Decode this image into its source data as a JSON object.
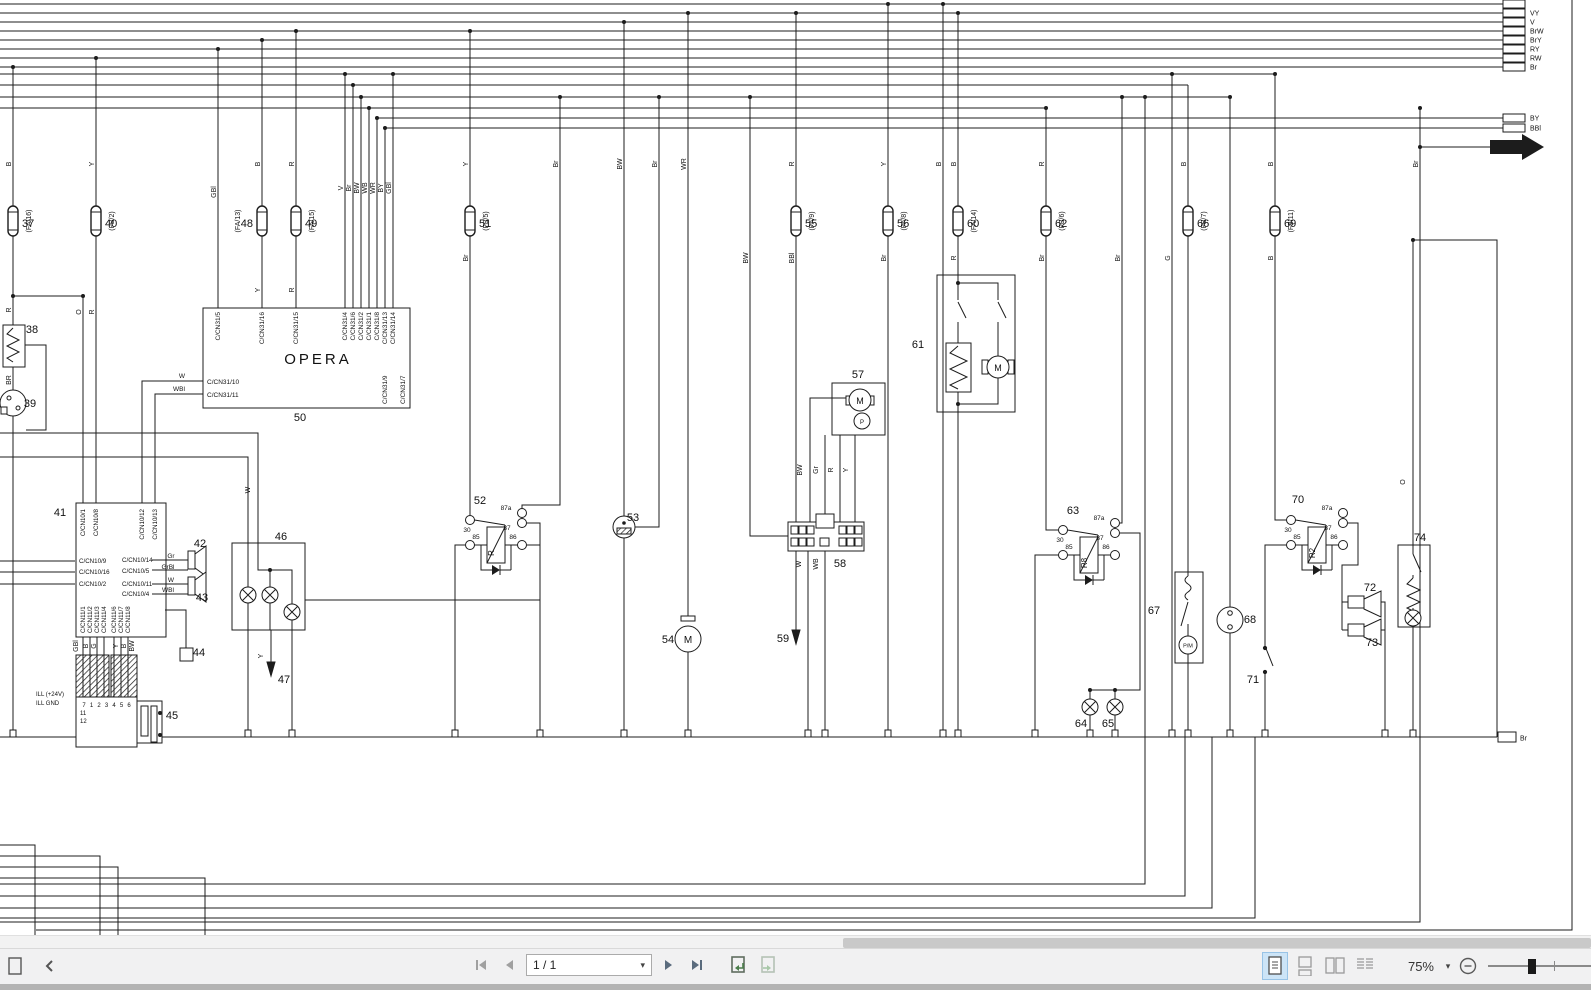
{
  "app": {
    "type": "pdf-viewer-wiring-diagram"
  },
  "toolbar": {
    "page_display": "1 / 1",
    "zoom_percent": "75%"
  },
  "colors": {
    "page_bg": "#ffffff",
    "diagram_line": "#1c1c1c",
    "toolbar_bg": "#f1f1f2",
    "toolbar_border": "#d9d9d9",
    "scrollbar_thumb": "#c9c9c9",
    "selected_view_bg": "#cce4f7",
    "selected_view_border": "#98c3e6",
    "icon_dark": "#4d4d4d",
    "icon_gray": "#9a9a9a",
    "bottom_strip": "#b3b3b3"
  },
  "diagram": {
    "opera": {
      "title": "OPERA",
      "top_pins": [
        [
          "C/CN31/5",
          218
        ],
        [
          "C/CN31/16",
          262
        ],
        [
          "C/CN31/15",
          296
        ],
        [
          "C/CN31/4",
          345
        ],
        [
          "C/CN31/6",
          353
        ],
        [
          "C/CN31/2",
          361
        ],
        [
          "C/CN31/1",
          369
        ],
        [
          "C/CN31/8",
          377
        ],
        [
          "C/CN31/13",
          385
        ],
        [
          "C/CN31/14",
          393
        ]
      ],
      "left_pins": [
        [
          "C/CN31/10",
          381
        ],
        [
          "C/CN31/11",
          394
        ]
      ],
      "bottom_pins": [
        [
          "C/CN31/9",
          385
        ],
        [
          "C/CN31/7",
          403
        ]
      ]
    },
    "unit41": {
      "top_pins": [
        [
          "C/CN10/1",
          83
        ],
        [
          "C/CN10/8",
          96
        ],
        [
          "C/CN10/12",
          142
        ],
        [
          "C/CN10/13",
          155
        ]
      ],
      "left_pins": [
        [
          "C/CN10/9",
          561
        ],
        [
          "C/CN10/16",
          572
        ],
        [
          "C/CN10/2",
          584
        ]
      ],
      "right_pins": [
        [
          "C/CN10/14",
          560
        ],
        [
          "C/CN10/5",
          571
        ],
        [
          "C/CN10/11",
          584
        ],
        [
          "C/CN10/4",
          594
        ]
      ],
      "bottom_pins": [
        [
          "C/CN11/1",
          83
        ],
        [
          "C/CN11/2",
          90
        ],
        [
          "C/CN11/3",
          97
        ],
        [
          "C/CN11/4",
          104
        ],
        [
          "C/CN11/6",
          114
        ],
        [
          "C/CN11/7",
          121
        ],
        [
          "C/CN11/8",
          128
        ]
      ]
    },
    "unit45": {
      "top_pins": [
        "7",
        "1",
        "2",
        "3",
        "4",
        "5",
        "6"
      ],
      "left_pins": [
        "11",
        "12"
      ],
      "ill_labels": [
        [
          "ILL (+24V)",
          36,
          696
        ],
        [
          "ILL GND",
          36,
          705
        ]
      ]
    },
    "right_terminals_top": [
      "",
      "VY",
      "V",
      "BrW",
      "BrY",
      "RY",
      "RW",
      "Br"
    ],
    "right_terminals_mid": [
      "BY",
      "BBl"
    ],
    "ground_terminal": "Br",
    "fuses": [
      {
        "num": "37",
        "conn": "(FA/16)",
        "x": 13,
        "side": 1
      },
      {
        "num": "40",
        "conn": "(FB/2)",
        "x": 96,
        "side": 1
      },
      {
        "num": "48",
        "conn": "(FA/13)",
        "x": 262,
        "side": -1
      },
      {
        "num": "49",
        "conn": "(FA/15)",
        "x": 296,
        "side": 1
      },
      {
        "num": "51",
        "conn": "(FB/5)",
        "x": 470,
        "side": 1
      },
      {
        "num": "55",
        "conn": "(FA/9)",
        "x": 796,
        "side": 1
      },
      {
        "num": "56",
        "conn": "(FA/8)",
        "x": 888,
        "side": 1
      },
      {
        "num": "60",
        "conn": "(FA/14)",
        "x": 958,
        "side": 1
      },
      {
        "num": "62",
        "conn": "(FB/6)",
        "x": 1046,
        "side": 1
      },
      {
        "num": "66",
        "conn": "(FB/7)",
        "x": 1188,
        "side": 1
      },
      {
        "num": "69",
        "conn": "(FB/11)",
        "x": 1275,
        "side": 1
      }
    ],
    "relays": [
      {
        "num": "52",
        "coil": "R",
        "cx": 496,
        "cy": 545
      },
      {
        "num": "63",
        "coil": "R8",
        "cx": 1089,
        "cy": 555
      },
      {
        "num": "70",
        "coil": "R2",
        "cx": 1317,
        "cy": 545
      }
    ],
    "relay_terminals": [
      "30",
      "87a",
      "87",
      "85",
      "86"
    ],
    "component_numbers": [
      [
        "38",
        32,
        333
      ],
      [
        "39",
        30,
        407
      ],
      [
        "41",
        60,
        516
      ],
      [
        "42",
        200,
        547
      ],
      [
        "43",
        202,
        601
      ],
      [
        "44",
        199,
        656
      ],
      [
        "45",
        172,
        719
      ],
      [
        "46",
        281,
        540
      ],
      [
        "47",
        284,
        683
      ],
      [
        "50",
        300,
        421
      ],
      [
        "52",
        480,
        504
      ],
      [
        "53",
        633,
        521
      ],
      [
        "54",
        668,
        643
      ],
      [
        "57",
        858,
        378
      ],
      [
        "58",
        840,
        567
      ],
      [
        "59",
        783,
        642
      ],
      [
        "61",
        918,
        348
      ],
      [
        "63",
        1073,
        514
      ],
      [
        "64",
        1081,
        727
      ],
      [
        "65",
        1108,
        727
      ],
      [
        "67",
        1154,
        614
      ],
      [
        "68",
        1250,
        623
      ],
      [
        "70",
        1298,
        503
      ],
      [
        "71",
        1253,
        683
      ],
      [
        "72",
        1370,
        591
      ],
      [
        "73",
        1372,
        646
      ],
      [
        "74",
        1420,
        541
      ]
    ],
    "wire_labels_rotated": [
      [
        "B",
        13,
        164
      ],
      [
        "Y",
        96,
        164
      ],
      [
        "GBl",
        218,
        192
      ],
      [
        "B",
        262,
        164
      ],
      [
        "R",
        296,
        164
      ],
      [
        "V",
        345,
        188
      ],
      [
        "Br",
        353,
        188
      ],
      [
        "BW",
        361,
        188
      ],
      [
        "WB",
        369,
        188
      ],
      [
        "WR",
        377,
        188
      ],
      [
        "BY",
        385,
        188
      ],
      [
        "GBl",
        393,
        188
      ],
      [
        "Y",
        470,
        164
      ],
      [
        "Br",
        560,
        164
      ],
      [
        "BW",
        624,
        164
      ],
      [
        "Br",
        659,
        164
      ],
      [
        "WR",
        688,
        164
      ],
      [
        "R",
        796,
        164
      ],
      [
        "Y",
        888,
        164
      ],
      [
        "B",
        943,
        164
      ],
      [
        "B",
        958,
        164
      ],
      [
        "R",
        1046,
        164
      ],
      [
        "B",
        1188,
        164
      ],
      [
        "B",
        1275,
        164
      ],
      [
        "Br",
        1420,
        164
      ],
      [
        "R",
        13,
        310
      ],
      [
        "O",
        83,
        312
      ],
      [
        "R",
        96,
        312
      ],
      [
        "Y",
        262,
        290
      ],
      [
        "R",
        296,
        290
      ],
      [
        "Br",
        470,
        258
      ],
      [
        "BW",
        750,
        258
      ],
      [
        "BBl",
        796,
        258
      ],
      [
        "Br",
        888,
        258
      ],
      [
        "R",
        958,
        258
      ],
      [
        "Br",
        1046,
        258
      ],
      [
        "Br",
        1122,
        258
      ],
      [
        "G",
        1172,
        258
      ],
      [
        "B",
        1275,
        258
      ],
      [
        "BR",
        13,
        380
      ],
      [
        "W",
        252,
        490
      ],
      [
        "Y",
        265,
        656
      ],
      [
        "O",
        1407,
        482
      ],
      [
        "BW",
        804,
        470
      ],
      [
        "Gr",
        820,
        470
      ],
      [
        "R",
        835,
        470
      ],
      [
        "Y",
        850,
        470
      ],
      [
        "W",
        803,
        564
      ],
      [
        "WB",
        820,
        564
      ],
      [
        "GBl",
        80,
        646
      ],
      [
        "B",
        90,
        646
      ],
      [
        "G",
        98,
        646
      ],
      [
        "Y",
        120,
        646
      ],
      [
        "B",
        128,
        646
      ],
      [
        "BW",
        136,
        646
      ]
    ],
    "wire_labels_h": [
      [
        "W",
        182,
        378
      ],
      [
        "WBl",
        179,
        391
      ],
      [
        "Gr",
        171,
        558
      ],
      [
        "GrBl",
        168,
        569
      ],
      [
        "W",
        171,
        582
      ],
      [
        "WBl",
        168,
        592
      ]
    ],
    "lamps": [
      [
        248,
        595
      ],
      [
        270,
        595
      ],
      [
        292,
        612
      ],
      [
        1090,
        707
      ],
      [
        1115,
        707
      ],
      [
        1413,
        618
      ]
    ],
    "ground_ticks": [
      13,
      248,
      292,
      455,
      540,
      624,
      688,
      808,
      825,
      888,
      943,
      958,
      1035,
      1090,
      1115,
      1172,
      1188,
      1230,
      1265,
      1385,
      1413
    ],
    "junction_dots": [
      [
        13,
        296
      ],
      [
        83,
        296
      ],
      [
        345,
        74
      ],
      [
        393,
        74
      ],
      [
        353,
        85
      ],
      [
        361,
        97
      ],
      [
        369,
        108
      ],
      [
        377,
        118
      ],
      [
        385,
        128
      ],
      [
        560,
        97
      ],
      [
        659,
        97
      ],
      [
        750,
        97
      ],
      [
        1122,
        97
      ],
      [
        1145,
        97
      ],
      [
        1230,
        97
      ],
      [
        1046,
        108
      ],
      [
        1275,
        74
      ],
      [
        1172,
        74
      ],
      [
        624,
        22
      ],
      [
        688,
        13
      ],
      [
        943,
        4
      ],
      [
        888,
        4
      ],
      [
        796,
        13
      ],
      [
        958,
        13
      ],
      [
        470,
        31
      ],
      [
        296,
        31
      ],
      [
        262,
        40
      ],
      [
        218,
        49
      ],
      [
        96,
        58
      ],
      [
        13,
        67
      ],
      [
        1420,
        147
      ],
      [
        1420,
        108
      ],
      [
        958,
        283
      ],
      [
        958,
        404
      ],
      [
        1090,
        690
      ],
      [
        1115,
        690
      ],
      [
        1413,
        240
      ],
      [
        270,
        570
      ]
    ]
  }
}
